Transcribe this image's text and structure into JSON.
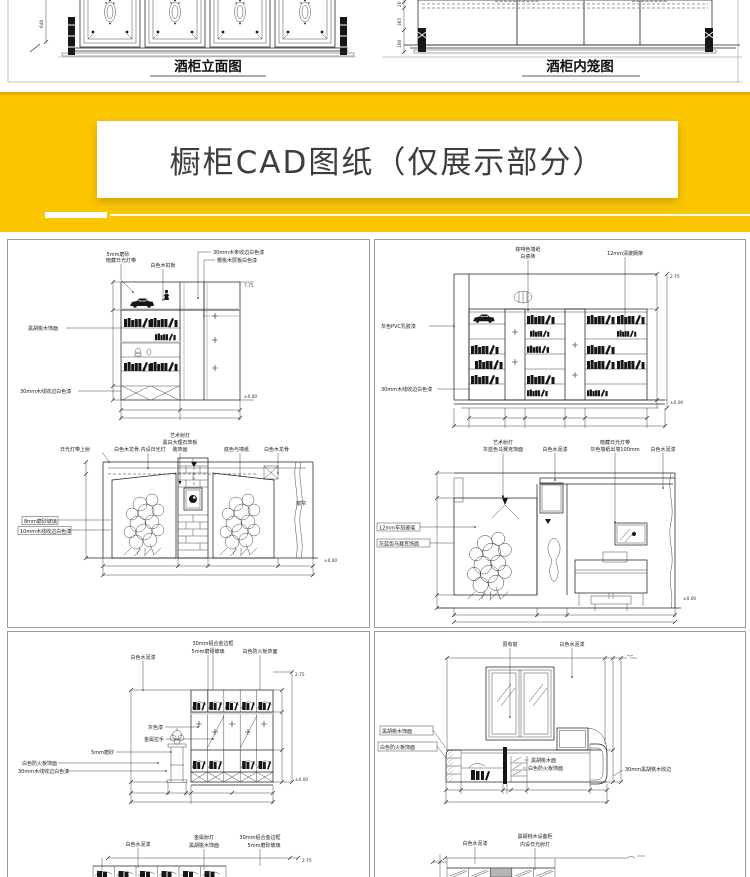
{
  "colors": {
    "banner_bg": "#FBC600",
    "banner_bg_dark": "#EBAE00",
    "title_color": "#3D3D3D",
    "panel_border": "#9B9B9B",
    "cad_line": "#1A1A1A"
  },
  "top_strip": {
    "left_caption": "酒柜立面图",
    "right_caption": "酒柜内笼图",
    "left_dim": "640",
    "right_dim_top": "20",
    "right_dim_mid": "365",
    "right_dim_bot": "100"
  },
  "banner": {
    "title": "橱柜CAD图纸（仅展示部分）"
  },
  "drawings": {
    "d_a": {
      "l1a": "5mm磨砂",
      "l1b": "暗藏日光灯带",
      "l2": "白色木扣板",
      "l3": "30mm木条收边白色漆",
      "l4": "樱桃木层板白色漆",
      "l5": "黑胡桃木饰面",
      "l6": "30mm木线收边白色漆",
      "ev_top": "7.75",
      "ev_bot": "±0.00"
    },
    "d_b": {
      "l1": "日光灯带上射",
      "l2": "白色木龙骨,内设日光灯",
      "l3a": "艺术射灯",
      "l3b": "黑白大理石饰板",
      "l3c": "装饰画",
      "l4": "底色与墙纸",
      "l5": "白色木龙骨",
      "l6": "8mm磨砂玻璃",
      "l7": "10mm木线收边白色漆",
      "l8": "窗帘",
      "ev_bot": "±0.00"
    },
    "d_c": {
      "l1a": "棕啡色墙纸",
      "l1b": "白瓷砖",
      "l2": "12mm清玻搁架",
      "l3": "灰色PVC乳胶漆",
      "l4": "30mm木线收边白色漆",
      "ev_top": "2.75",
      "ev_bot": "±0.00"
    },
    "d_d": {
      "l1a": "艺术射灯",
      "l1b": "灰蓝色马赛克饰面",
      "l2": "白色水泥漆",
      "l3a": "暗藏日光灯带",
      "l3b": "灰色墙纸出墙100mm",
      "l4": "白色水泥漆",
      "l5": "12mm车刻玻璃",
      "l6": "灰蓝色马赛克饰面",
      "ev_bot": "±0.00"
    },
    "d_e": {
      "l1": "白色水泥漆",
      "l2a": "30mm铝合金边框",
      "l2b": "5mm磨砂玻璃",
      "l3": "白色防火板饰面",
      "l4": "灰色漆",
      "l5": "金属拉手",
      "l6": "5mm磨砂",
      "l7a": "白色防火板饰面",
      "l7b": "30mm木线收边白色漆",
      "ev_top": "2.75",
      "ev_bot": "±0.00"
    },
    "d_f": {
      "l1": "白色水泥漆",
      "l2a": "金属射灯",
      "l2b": "黑胡桃木饰面",
      "l3a": "30mm铝合金边框",
      "l3b": "5mm磨砂玻璃",
      "ev_top": "2.75"
    },
    "d_g": {
      "l1": "原有窗",
      "l2": "白色水泥漆",
      "l3": "黑胡桃木饰面",
      "l4": "白色防火板饰面",
      "l5a": "黑胡桃木面",
      "l5b": "白色防火板饰面",
      "l6": "30mm黑胡桃木收边"
    },
    "d_h": {
      "l1": "白色水泥漆",
      "l2a": "黑胡桃木设备柜",
      "l2b": "内设日光射灯"
    }
  }
}
